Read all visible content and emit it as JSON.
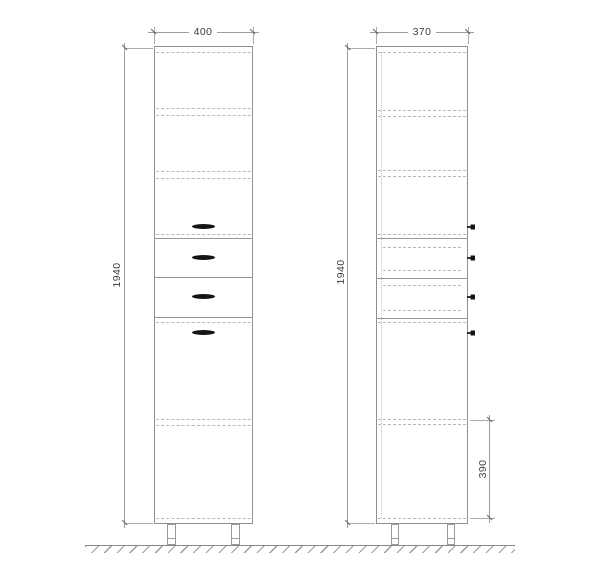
{
  "drawing": {
    "type": "cabinet elevation drawing, front view and side view",
    "views": {
      "front": "front elevation",
      "side": "side elevation"
    }
  },
  "dims": {
    "front_width": "400",
    "front_height": "1940",
    "side_width": "370",
    "side_height": "1940",
    "side_plinth": "390"
  },
  "colors": {
    "background": "#ffffff",
    "outline": "#8f8f8f",
    "hidden_line": "#b8b8b8",
    "dimension_line": "#9d9d9d",
    "dimension_text": "#3d3d3d",
    "handle": "#141414"
  },
  "icons": {
    "handle": "black-lens-ellipse-handle",
    "knob": "black-protruding-knob"
  }
}
